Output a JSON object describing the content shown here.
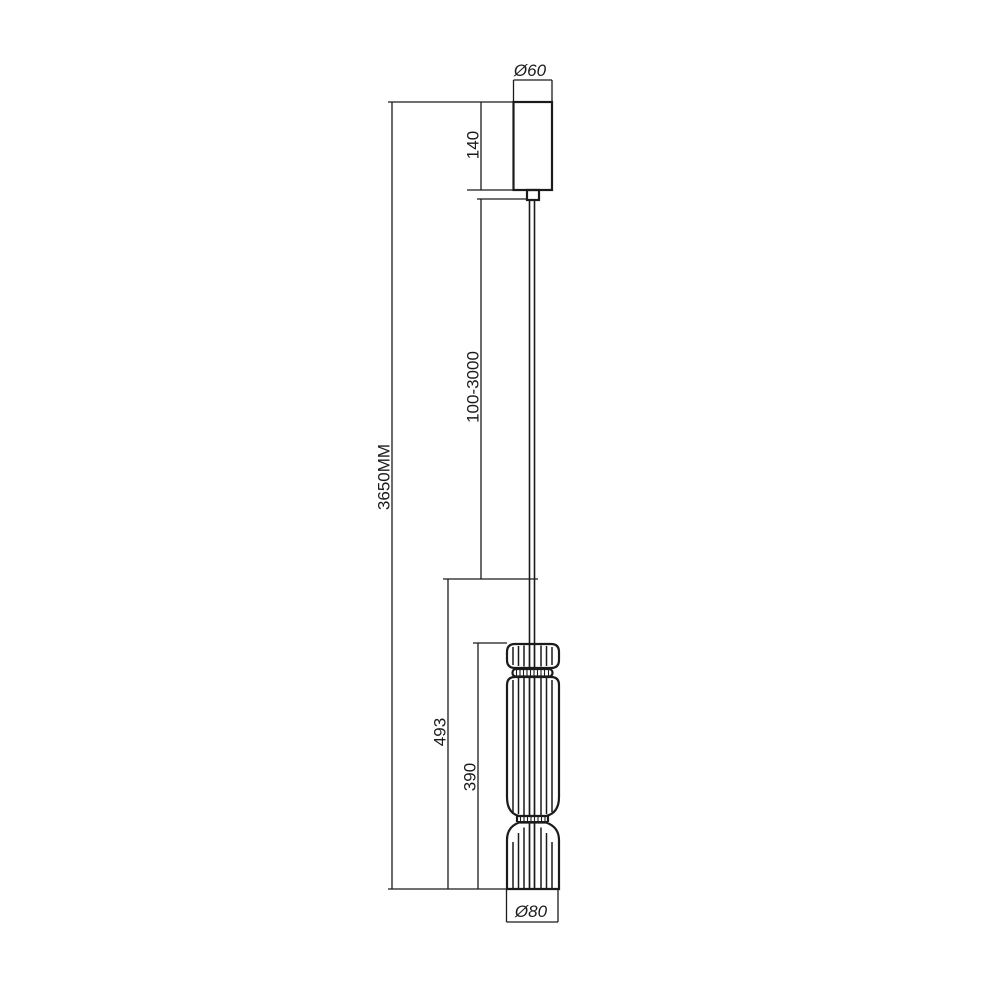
{
  "background": "#ffffff",
  "drawing": {
    "type": "technical-dimension-drawing",
    "subject": "pendant lamp side view with dimensions",
    "line_color": "#1b1b1b",
    "units_note": "MM",
    "labels": {
      "top_diameter": "Ø60",
      "canopy_height": "140",
      "suspension_length": "100-3000",
      "overall_height": "3650MM",
      "fixture_length": "493",
      "shade_height": "390",
      "bottom_diameter": "Ø80"
    }
  }
}
